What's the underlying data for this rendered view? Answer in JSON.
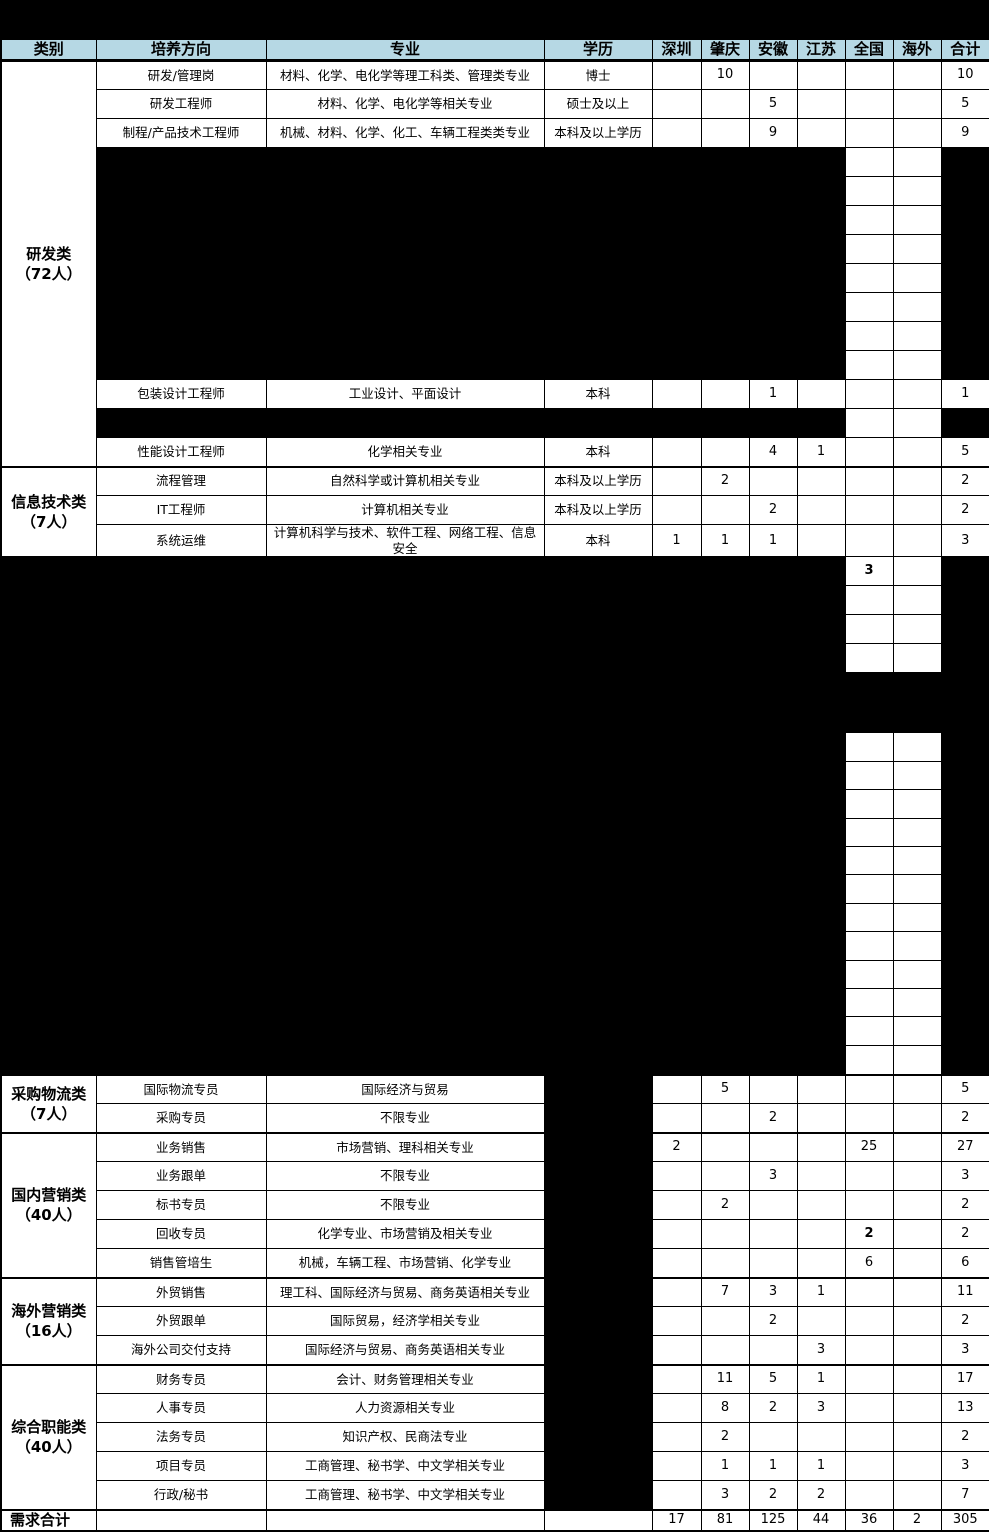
{
  "header": {
    "columns": [
      "类别",
      "培养方向",
      "专业",
      "学历",
      "深圳",
      "肇庆",
      "安徽",
      "江苏",
      "全国",
      "海外",
      "合计"
    ]
  },
  "categories": [
    {
      "line1": "研发类",
      "line2": "（72人）"
    },
    {
      "line1": "信息技术类",
      "line2": "（7人）"
    },
    {
      "line1": "采购物流类",
      "line2": "（7人）"
    },
    {
      "line1": "国内营销类",
      "line2": "（40人）"
    },
    {
      "line1": "海外营销类",
      "line2": "（16人）"
    },
    {
      "line1": "综合职能类",
      "line2": "（40人）"
    }
  ],
  "rows": [
    {
      "direction": "研发/管理岗",
      "major": "材料、化学、电化学等理工科类、管理类专业",
      "degree": "博士",
      "values": {
        "sz": "",
        "zq": "10",
        "ah": "",
        "js": "",
        "qg": "",
        "hw": "",
        "total": "10"
      }
    },
    {
      "direction": "研发工程师",
      "major": "材料、化学、电化学等相关专业",
      "degree": "硕士及以上",
      "values": {
        "sz": "",
        "zq": "",
        "ah": "5",
        "js": "",
        "qg": "",
        "hw": "",
        "total": "5"
      }
    },
    {
      "direction": "制程/产品技术工程师",
      "major": "机械、材料、化学、化工、车辆工程类类专业",
      "degree": "本科及以上学历",
      "values": {
        "sz": "",
        "zq": "",
        "ah": "9",
        "js": "",
        "qg": "",
        "hw": "",
        "total": "9"
      }
    },
    {
      "direction": "包装设计工程师",
      "major": "工业设计、平面设计",
      "degree": "本科",
      "values": {
        "sz": "",
        "zq": "",
        "ah": "1",
        "js": "",
        "qg": "",
        "hw": "",
        "total": "1"
      }
    },
    {
      "direction": "性能设计工程师",
      "major": "化学相关专业",
      "degree": "本科",
      "values": {
        "sz": "",
        "zq": "",
        "ah": "4",
        "js": "1",
        "qg": "",
        "hw": "",
        "total": "5"
      }
    },
    {
      "direction": "流程管理",
      "major": "自然科学或计算机相关专业",
      "degree": "本科及以上学历",
      "values": {
        "sz": "",
        "zq": "2",
        "ah": "",
        "js": "",
        "qg": "",
        "hw": "",
        "total": "2"
      }
    },
    {
      "direction": "IT工程师",
      "major": "计算机相关专业",
      "degree": "本科及以上学历",
      "values": {
        "sz": "",
        "zq": "",
        "ah": "2",
        "js": "",
        "qg": "",
        "hw": "",
        "total": "2"
      }
    },
    {
      "direction": "系统运维",
      "major": "计算机科学与技术、软件工程、网络工程、信息安全",
      "degree": "本科",
      "values": {
        "sz": "1",
        "zq": "1",
        "ah": "1",
        "js": "",
        "qg": "",
        "hw": "",
        "total": "3"
      }
    },
    {
      "direction": "国际物流专员",
      "major": "国际经济与贸易",
      "values": {
        "sz": "",
        "zq": "5",
        "ah": "",
        "js": "",
        "qg": "",
        "hw": "",
        "total": "5"
      }
    },
    {
      "direction": "采购专员",
      "major": "不限专业",
      "values": {
        "sz": "",
        "zq": "",
        "ah": "2",
        "js": "",
        "qg": "",
        "hw": "",
        "total": "2"
      }
    },
    {
      "direction": "业务销售",
      "major": "市场营销、理科相关专业",
      "values": {
        "sz": "2",
        "zq": "",
        "ah": "",
        "js": "",
        "qg": "25",
        "hw": "",
        "total": "27"
      }
    },
    {
      "direction": "业务跟单",
      "major": "不限专业",
      "values": {
        "sz": "",
        "zq": "",
        "ah": "3",
        "js": "",
        "qg": "",
        "hw": "",
        "total": "3"
      }
    },
    {
      "direction": "标书专员",
      "major": "不限专业",
      "values": {
        "sz": "",
        "zq": "2",
        "ah": "",
        "js": "",
        "qg": "",
        "hw": "",
        "total": "2"
      }
    },
    {
      "direction": "回收专员",
      "major": "化学专业、市场营销及相关专业",
      "values": {
        "sz": "",
        "zq": "",
        "ah": "",
        "js": "",
        "qg": "2",
        "hw": "",
        "total": "2"
      }
    },
    {
      "direction": "销售管培生",
      "major": "机械，车辆工程、市场营销、化学专业",
      "values": {
        "sz": "",
        "zq": "",
        "ah": "",
        "js": "",
        "qg": "6",
        "hw": "",
        "total": "6"
      }
    },
    {
      "direction": "外贸销售",
      "major": "理工科、国际经济与贸易、商务英语相关专业",
      "values": {
        "sz": "",
        "zq": "7",
        "ah": "3",
        "js": "1",
        "qg": "",
        "hw": "",
        "total": "11"
      }
    },
    {
      "direction": "外贸跟单",
      "major": "国际贸易，经济学相关专业",
      "values": {
        "sz": "",
        "zq": "",
        "ah": "2",
        "js": "",
        "qg": "",
        "hw": "",
        "total": "2"
      }
    },
    {
      "direction": "海外公司交付支持",
      "major": "国际经济与贸易、商务英语相关专业",
      "values": {
        "sz": "",
        "zq": "",
        "ah": "",
        "js": "3",
        "qg": "",
        "hw": "",
        "total": "3"
      }
    },
    {
      "direction": "财务专员",
      "major": "会计、财务管理相关专业",
      "values": {
        "sz": "",
        "zq": "11",
        "ah": "5",
        "js": "1",
        "qg": "",
        "hw": "",
        "total": "17"
      }
    },
    {
      "direction": "人事专员",
      "major": "人力资源相关专业",
      "values": {
        "sz": "",
        "zq": "8",
        "ah": "2",
        "js": "3",
        "qg": "",
        "hw": "",
        "total": "13"
      }
    },
    {
      "direction": "法务专员",
      "major": "知识产权、民商法专业",
      "values": {
        "sz": "",
        "zq": "2",
        "ah": "",
        "js": "",
        "qg": "",
        "hw": "",
        "total": "2"
      }
    },
    {
      "direction": "项目专员",
      "major": "工商管理、秘书学、中文学相关专业",
      "values": {
        "sz": "",
        "zq": "1",
        "ah": "1",
        "js": "1",
        "qg": "",
        "hw": "",
        "total": "3"
      }
    },
    {
      "direction": "行政/秘书",
      "major": "工商管理、秘书学、中文学相关专业",
      "values": {
        "sz": "",
        "zq": "3",
        "ah": "2",
        "js": "2",
        "qg": "",
        "hw": "",
        "total": "7"
      }
    }
  ],
  "redacted_region": {
    "national_value": "3"
  },
  "totals": {
    "label": "需求合计",
    "values": {
      "sz": "17",
      "zq": "81",
      "ah": "125",
      "js": "44",
      "qg": "36",
      "hw": "2",
      "total": "305"
    }
  },
  "colors": {
    "header_bg": "#b6d8e4",
    "redaction": "#000000",
    "grid": "#000000",
    "cell_bg": "#ffffff"
  }
}
